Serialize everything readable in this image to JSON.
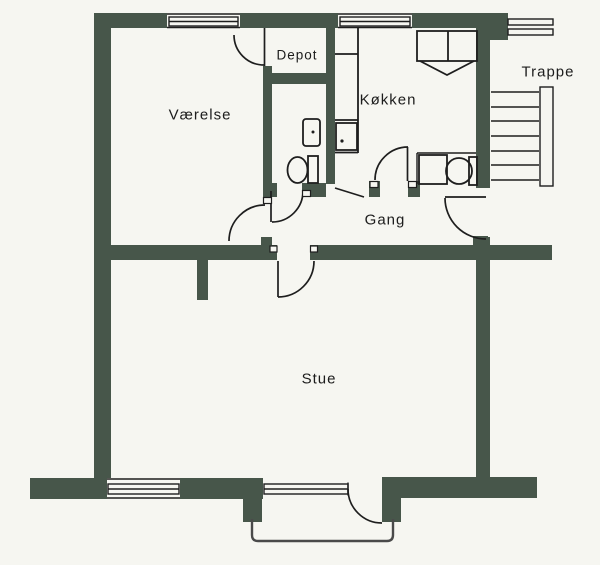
{
  "plan": {
    "kind": "apartment floor plan",
    "rooms": {
      "vaerelse": {
        "label": "Værelse"
      },
      "depot": {
        "label": "Depot"
      },
      "koekken": {
        "label": "Køkken"
      },
      "trappe": {
        "label": "Trappe"
      },
      "gang": {
        "label": "Gang"
      },
      "stue": {
        "label": "Stue"
      }
    },
    "fixtures": [
      {
        "name": "bathroom-toilet"
      },
      {
        "name": "bathroom-sink"
      },
      {
        "name": "wc-toilet"
      },
      {
        "name": "wc-shower-square"
      },
      {
        "name": "kitchen-counter"
      },
      {
        "name": "kitchen-stove"
      },
      {
        "name": "kitchen-appliance-unit"
      },
      {
        "name": "staircase"
      },
      {
        "name": "balcony"
      }
    ]
  },
  "colors": {
    "wall": "#47564a",
    "line": "#1e1e1e",
    "paper": "#f6f6f1",
    "balcony": "#4a4a4a"
  }
}
